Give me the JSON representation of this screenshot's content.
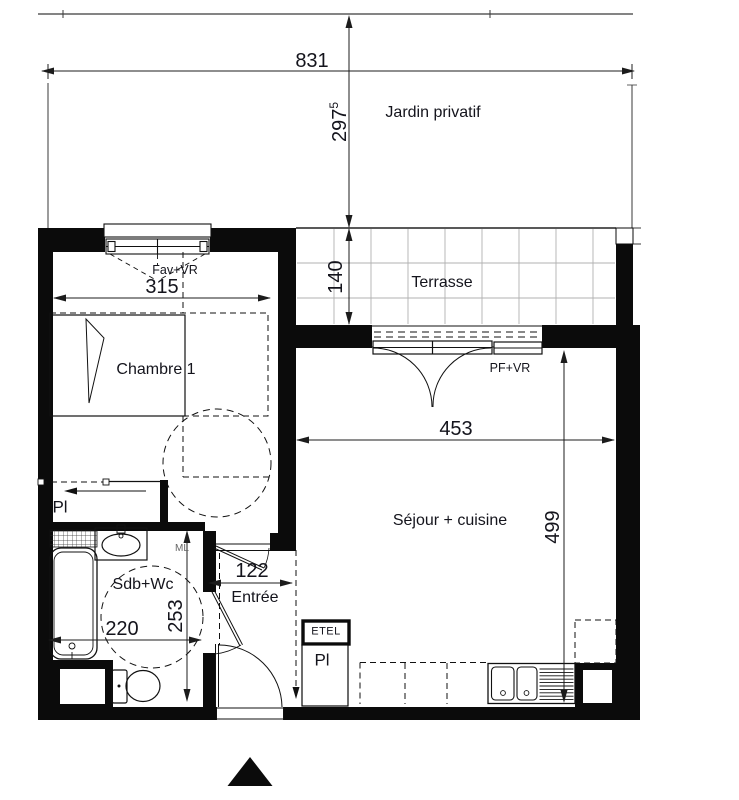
{
  "plan": {
    "areas": {
      "jardin": "Jardin privatif",
      "terrasse": "Terrasse",
      "chambre": "Chambre 1",
      "sejour": "Séjour + cuisine",
      "sdb": "Sdb+Wc",
      "entree": "Entrée"
    },
    "features": {
      "placard_chambre": "Pl",
      "placard_sejour": "Pl",
      "etel": "ETEL",
      "ml": "ML",
      "window_chambre": "Fav+VR",
      "door_sejour": "PF+VR"
    },
    "dimensions_cm": {
      "site_width": "831",
      "jardin_depth": {
        "main": "297",
        "sup": "5"
      },
      "terrasse_depth": "140",
      "chambre_width": "315",
      "sejour_width": "453",
      "sejour_depth": "499",
      "sdb_width": "220",
      "sdb_depth": "253",
      "entree_width": "122"
    }
  }
}
